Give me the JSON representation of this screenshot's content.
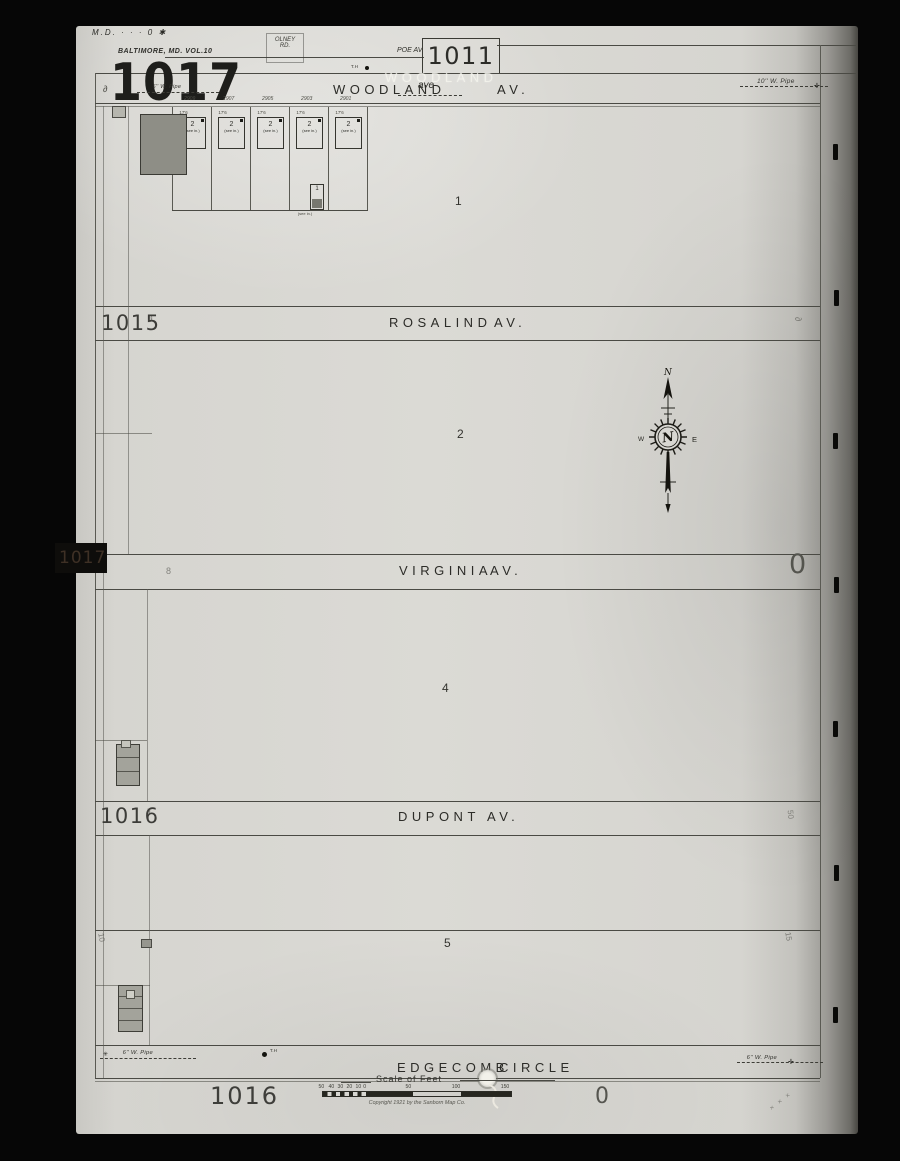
{
  "header": {
    "corner_note": "M.D. · · · 0 ✱",
    "olney_line1": "OLNEY",
    "olney_line2": "RD.",
    "volume_label": "BALTIMORE, MD. VOL.10",
    "sheet_number": "1017",
    "pipe_note": "6'' W. Pipe",
    "poe_label": "POE AV.",
    "adjacent_sheet": "1011",
    "th_marker": "T.H"
  },
  "streets": {
    "woodland": {
      "name": "WOODLAND",
      "suffix": "AV.",
      "ghost": "WOODLAND",
      "annotation": "ave"
    },
    "rosalind": {
      "name": "ROSALIND",
      "suffix": "AV."
    },
    "virginia": {
      "name": "VIRGINIA",
      "suffix": "AV."
    },
    "dupont": {
      "name": "DUPONT",
      "suffix": "AV."
    },
    "edgecomb": {
      "name": "EDGECOMB",
      "suffix": "CIRCLE"
    }
  },
  "blocks": {
    "block1": "1",
    "block2": "2",
    "block4": "4",
    "block5": "5"
  },
  "margins": {
    "left_1015": "1015",
    "left_1016": "1016",
    "tab_1017": "1017",
    "bottom_1016": "1016",
    "right_zero": "0",
    "bottom_zero": "0",
    "ornament": "∂",
    "tab_ornament": "8",
    "right_50": "50",
    "lot_left_10": "10",
    "lot_right_15": "15",
    "corner_marks": "× × ×"
  },
  "pipes": {
    "top_right": "10'' W. Pipe",
    "bottom_left": "6'' W. Pipe",
    "bottom_right": "6'' W. Pipe"
  },
  "lots": {
    "house_numbers": [
      "2909",
      "2907",
      "2905",
      "2903",
      "2901"
    ],
    "story": "2",
    "note": "(see in.)",
    "dim": "17'6",
    "small_story": "1",
    "small_note": "(see in.)"
  },
  "compass": {
    "n": "N",
    "e": "E",
    "w": "W"
  },
  "scalebar": {
    "title": "Scale of Feet",
    "ticks": [
      "50",
      "40",
      "30",
      "20",
      "10",
      "0",
      "50",
      "100",
      "150"
    ],
    "copyright": "Copyright 1921 by the Sanborn Map Co."
  },
  "bottom": {
    "th_marker": "T.H"
  }
}
